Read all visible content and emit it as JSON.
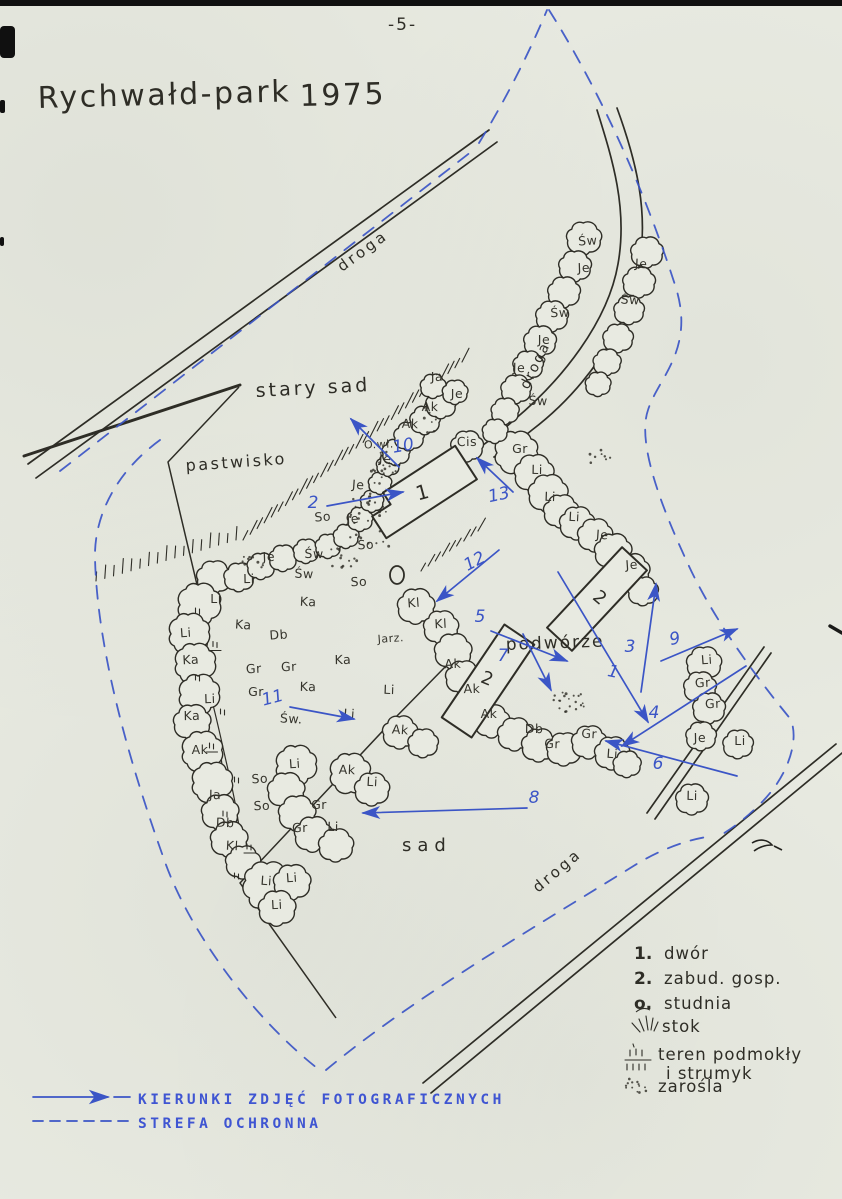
{
  "page": {
    "number": "-5-",
    "title": "Rychwałd-park",
    "year": "1975"
  },
  "colors": {
    "paper": "#e8eae1",
    "ink": "#2e2d26",
    "pen_blue": "#3b55c6",
    "typed_blue": "#3f55d2"
  },
  "map": {
    "area_labels": [
      {
        "text": "stary sad",
        "x": 256,
        "y": 397,
        "size": 19,
        "ls": 3,
        "rot": -3
      },
      {
        "text": "pastwisko",
        "x": 186,
        "y": 471,
        "size": 16,
        "ls": 2.5,
        "rot": -4
      },
      {
        "text": "podwórze",
        "x": 506,
        "y": 650,
        "size": 17,
        "ls": 2,
        "rot": -2
      },
      {
        "text": "sad",
        "x": 402,
        "y": 851,
        "size": 18,
        "ls": 6,
        "rot": 0
      }
    ],
    "road_labels": [
      {
        "text": "droga",
        "x": 342,
        "y": 272,
        "rot": -36,
        "size": 15,
        "ls": 3
      },
      {
        "text": "droga",
        "x": 528,
        "y": 390,
        "rot": -64,
        "size": 14,
        "ls": 2
      },
      {
        "text": "droga",
        "x": 538,
        "y": 893,
        "rot": -40,
        "size": 15,
        "ls": 3
      }
    ],
    "tree_labels": [
      {
        "t": "Li",
        "x": 186,
        "y": 637
      },
      {
        "t": "Ka",
        "x": 191,
        "y": 664
      },
      {
        "t": "Li",
        "x": 210,
        "y": 703
      },
      {
        "t": "Ka",
        "x": 192,
        "y": 720
      },
      {
        "t": "Ak",
        "x": 200,
        "y": 754
      },
      {
        "t": "Ja",
        "x": 215,
        "y": 799
      },
      {
        "t": "Db",
        "x": 225,
        "y": 827
      },
      {
        "t": "Kl",
        "x": 232,
        "y": 850
      },
      {
        "t": "Li",
        "x": 266,
        "y": 885
      },
      {
        "t": "Li",
        "x": 292,
        "y": 882
      },
      {
        "t": "Li",
        "x": 277,
        "y": 909
      },
      {
        "t": "Je",
        "x": 269,
        "y": 561
      },
      {
        "t": "Li",
        "x": 249,
        "y": 583
      },
      {
        "t": "Li",
        "x": 216,
        "y": 603
      },
      {
        "t": "Św",
        "x": 314,
        "y": 558
      },
      {
        "t": "Św",
        "x": 304,
        "y": 578
      },
      {
        "t": "Ka",
        "x": 308,
        "y": 606
      },
      {
        "t": "Ka",
        "x": 243,
        "y": 629
      },
      {
        "t": "Db",
        "x": 279,
        "y": 639
      },
      {
        "t": "Gr",
        "x": 254,
        "y": 673
      },
      {
        "t": "Gr",
        "x": 289,
        "y": 671
      },
      {
        "t": "Ka",
        "x": 343,
        "y": 664
      },
      {
        "t": "Gr",
        "x": 256,
        "y": 696
      },
      {
        "t": "Ka",
        "x": 308,
        "y": 691
      },
      {
        "t": "Li",
        "x": 389,
        "y": 694
      },
      {
        "t": "Św.",
        "x": 291,
        "y": 723
      },
      {
        "t": "Li",
        "x": 349,
        "y": 718
      },
      {
        "t": "Jarz.",
        "x": 391,
        "y": 642
      },
      {
        "t": "So",
        "x": 366,
        "y": 549
      },
      {
        "t": "So",
        "x": 359,
        "y": 586
      },
      {
        "t": "Ja",
        "x": 437,
        "y": 381
      },
      {
        "t": "Je",
        "x": 457,
        "y": 398
      },
      {
        "t": "Ak",
        "x": 430,
        "y": 411
      },
      {
        "t": "Ak",
        "x": 410,
        "y": 428
      },
      {
        "t": "Je",
        "x": 385,
        "y": 463
      },
      {
        "t": "Je",
        "x": 358,
        "y": 489
      },
      {
        "t": "So",
        "x": 323,
        "y": 521
      },
      {
        "t": "Je",
        "x": 353,
        "y": 523
      },
      {
        "t": "O.wł.",
        "x": 379,
        "y": 448
      },
      {
        "t": "Cis",
        "x": 467,
        "y": 446
      },
      {
        "t": "Gr",
        "x": 520,
        "y": 453
      },
      {
        "t": "Li",
        "x": 537,
        "y": 474
      },
      {
        "t": "Li",
        "x": 550,
        "y": 501
      },
      {
        "t": "Li",
        "x": 574,
        "y": 521
      },
      {
        "t": "Je",
        "x": 602,
        "y": 539
      },
      {
        "t": "Je",
        "x": 632,
        "y": 569
      },
      {
        "t": "Św",
        "x": 588,
        "y": 245
      },
      {
        "t": "Je",
        "x": 584,
        "y": 272
      },
      {
        "t": "Św",
        "x": 560,
        "y": 317
      },
      {
        "t": "Je",
        "x": 544,
        "y": 344
      },
      {
        "t": "Je",
        "x": 519,
        "y": 372
      },
      {
        "t": "Św",
        "x": 538,
        "y": 405
      },
      {
        "t": "Je",
        "x": 641,
        "y": 268
      },
      {
        "t": "Św",
        "x": 630,
        "y": 304
      },
      {
        "t": "Kl",
        "x": 414,
        "y": 607
      },
      {
        "t": "Kl",
        "x": 441,
        "y": 628
      },
      {
        "t": "Ak",
        "x": 453,
        "y": 668
      },
      {
        "t": "Ak",
        "x": 472,
        "y": 693
      },
      {
        "t": "Ak",
        "x": 489,
        "y": 718
      },
      {
        "t": "Db",
        "x": 534,
        "y": 733
      },
      {
        "t": "Gr",
        "x": 552,
        "y": 748
      },
      {
        "t": "Gr",
        "x": 589,
        "y": 738
      },
      {
        "t": "Li",
        "x": 612,
        "y": 758
      },
      {
        "t": "Li",
        "x": 707,
        "y": 664
      },
      {
        "t": "Gr",
        "x": 703,
        "y": 687
      },
      {
        "t": "Gr",
        "x": 713,
        "y": 708
      },
      {
        "t": "Je",
        "x": 700,
        "y": 742
      },
      {
        "t": "Li",
        "x": 740,
        "y": 745
      },
      {
        "t": "Li",
        "x": 692,
        "y": 800
      },
      {
        "t": "Ak",
        "x": 347,
        "y": 774
      },
      {
        "t": "Li",
        "x": 372,
        "y": 786
      },
      {
        "t": "Ak",
        "x": 400,
        "y": 734
      },
      {
        "t": "Li",
        "x": 295,
        "y": 768
      },
      {
        "t": "So",
        "x": 260,
        "y": 783
      },
      {
        "t": "So",
        "x": 262,
        "y": 810
      },
      {
        "t": "Gr",
        "x": 300,
        "y": 832
      },
      {
        "t": "Gr",
        "x": 319,
        "y": 809
      },
      {
        "t": "Li",
        "x": 333,
        "y": 831
      }
    ],
    "building_labels": [
      {
        "t": "1",
        "x": 424,
        "y": 499,
        "rot": -15,
        "size": 20
      },
      {
        "t": "2",
        "x": 596,
        "y": 602,
        "rot": 40,
        "size": 18
      },
      {
        "t": "2",
        "x": 485,
        "y": 684,
        "rot": 22,
        "size": 18
      }
    ],
    "photo_arrows": [
      {
        "n": "1",
        "lx": 612,
        "ly": 677,
        "lr": 12,
        "x1": 558,
        "y1": 572,
        "x2": 648,
        "y2": 722
      },
      {
        "n": "2",
        "lx": 313,
        "ly": 508,
        "lr": 0,
        "x1": 327,
        "y1": 506,
        "x2": 403,
        "y2": 492
      },
      {
        "n": "3",
        "lx": 630,
        "ly": 652,
        "lr": 0,
        "x1": 641,
        "y1": 692,
        "x2": 656,
        "y2": 584
      },
      {
        "n": "4",
        "lx": 654,
        "ly": 718,
        "lr": 0,
        "x1": 746,
        "y1": 666,
        "x2": 622,
        "y2": 746
      },
      {
        "n": "5",
        "lx": 480,
        "ly": 622,
        "lr": 0,
        "x1": 491,
        "y1": 631,
        "x2": 567,
        "y2": 661
      },
      {
        "n": "6",
        "lx": 658,
        "ly": 769,
        "lr": 0,
        "x1": 737,
        "y1": 776,
        "x2": 606,
        "y2": 741
      },
      {
        "n": "7",
        "lx": 503,
        "ly": 661,
        "lr": 0,
        "x1": 523,
        "y1": 634,
        "x2": 551,
        "y2": 690
      },
      {
        "n": "8",
        "lx": 534,
        "ly": 803,
        "lr": 0,
        "x1": 527,
        "y1": 808,
        "x2": 363,
        "y2": 813
      },
      {
        "n": "9",
        "lx": 676,
        "ly": 644,
        "lr": -12,
        "x1": 661,
        "y1": 661,
        "x2": 737,
        "y2": 629
      },
      {
        "n": "10",
        "lx": 404,
        "ly": 451,
        "lr": -10,
        "x1": 399,
        "y1": 467,
        "x2": 351,
        "y2": 419
      },
      {
        "n": "11",
        "lx": 274,
        "ly": 703,
        "lr": -15,
        "x1": 290,
        "y1": 707,
        "x2": 354,
        "y2": 719
      },
      {
        "n": "12",
        "lx": 477,
        "ly": 566,
        "lr": -28,
        "x1": 499,
        "y1": 550,
        "x2": 437,
        "y2": 601
      },
      {
        "n": "13",
        "lx": 500,
        "ly": 500,
        "lr": -12,
        "x1": 513,
        "y1": 492,
        "x2": 477,
        "y2": 458
      }
    ],
    "legend": {
      "items": [
        {
          "key": "1.",
          "label": "dwór"
        },
        {
          "key": "2.",
          "label": "zabud. gosp."
        },
        {
          "key": "o.",
          "label": "studnia"
        },
        {
          "key": "",
          "label": "stok"
        },
        {
          "key": "",
          "label": "teren podmokły",
          "label2": "i strumyk"
        },
        {
          "key": "",
          "label": "zarośla"
        }
      ]
    },
    "photo_legend": {
      "solid_label": "KIERUNKI ZDJĘĆ FOTOGRAFICZNYCH",
      "dashed_label": "STREFA OCHRONNA"
    }
  }
}
